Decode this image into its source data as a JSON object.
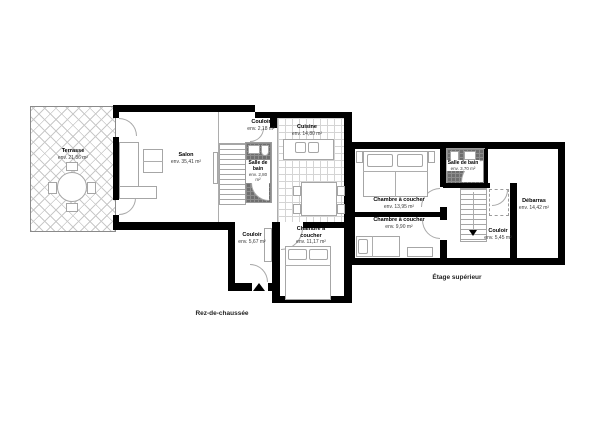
{
  "plan": {
    "colors": {
      "wall": "#000000",
      "furniture_line": "#a6a6a6",
      "tile_line": "#d4d4d4",
      "dark_tile": "#6e6e6e",
      "background": "#ffffff"
    },
    "ground": {
      "label": "Rez-de-chaussée",
      "rooms": {
        "terrasse": {
          "name": "Terrasse",
          "area": "env. 21,86 m²"
        },
        "salon": {
          "name": "Salon",
          "area": "env. 35,41 m²"
        },
        "couloir_haut": {
          "name": "Couloir",
          "area": "env. 2,18 m²"
        },
        "cuisine": {
          "name": "Cuisine",
          "area": "env. 14,80 m²"
        },
        "salle_de_bain": {
          "name": "Salle de bain",
          "area": "env. 2,80 m²"
        },
        "couloir": {
          "name": "Couloir",
          "area": "env. 5,67 m²"
        },
        "chambre": {
          "name": "Chambre à coucher",
          "area": "env. 11,17 m²"
        }
      }
    },
    "upper": {
      "label": "Étage supérieur",
      "rooms": {
        "chambre1": {
          "name": "Chambre à coucher",
          "area": "env. 13,95 m²"
        },
        "chambre2": {
          "name": "Chambre à coucher",
          "area": "env. 9,90 m²"
        },
        "salle_de_bain": {
          "name": "Salle de bain",
          "area": "env. 3,70 m²"
        },
        "couloir": {
          "name": "Couloir",
          "area": "env. 5,45 m²"
        },
        "debarras": {
          "name": "Débarras",
          "area": "env. 14,42 m²"
        }
      }
    }
  }
}
